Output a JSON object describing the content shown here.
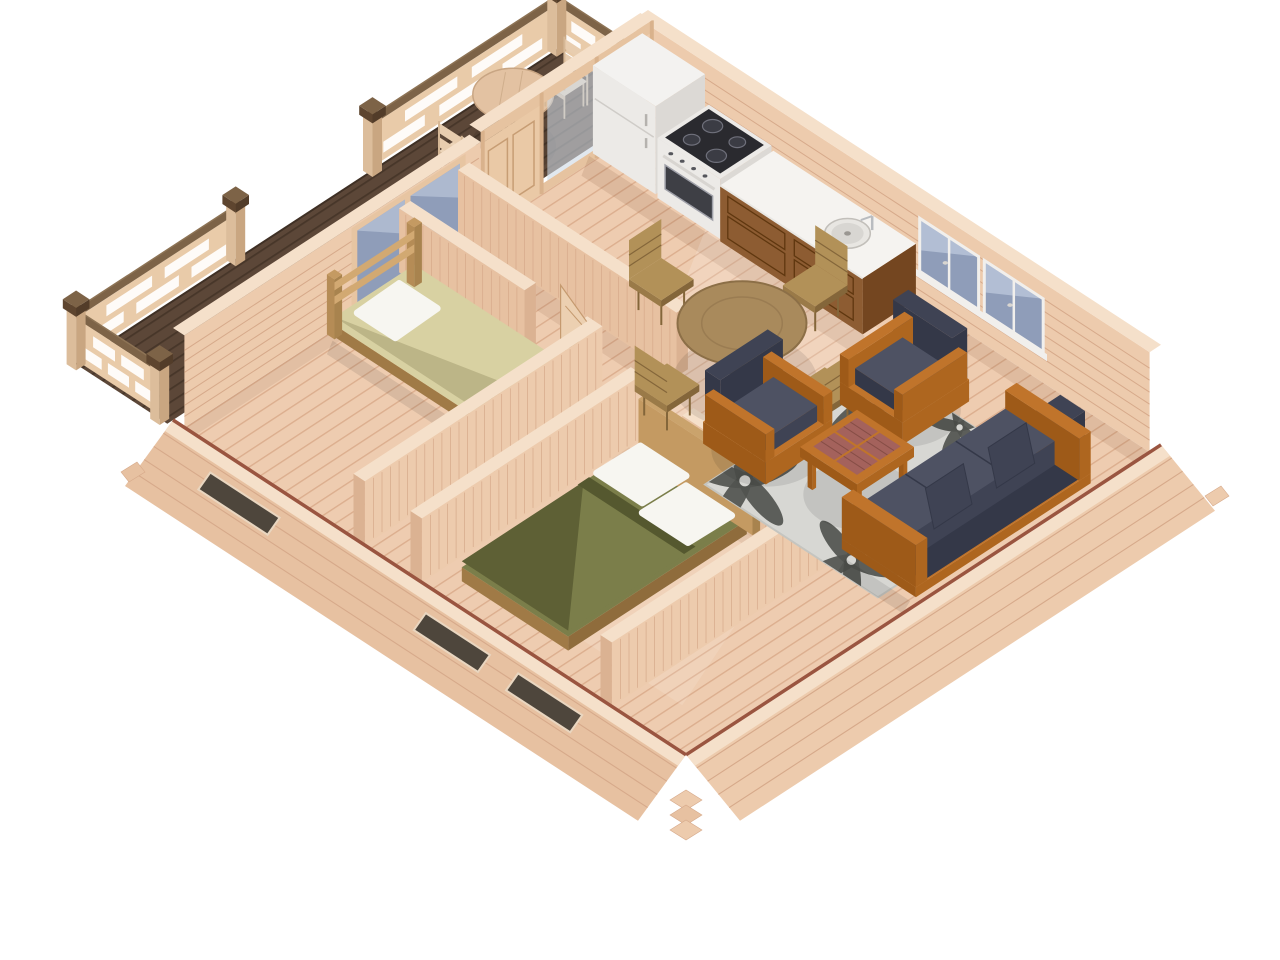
{
  "meta": {
    "kind": "3d-floorplan-render",
    "style": "isometric cutaway view of a one-storey log cabin",
    "background": "#ffffff"
  },
  "palette": {
    "floor": "#eeccb0",
    "floorLine": "#dcae8e",
    "deck": "#5c4738",
    "deckLine": "#473629",
    "wallFace": "#edcbad",
    "wallFaceAlt": "#e7c1a1",
    "wallLine": "#d6a98a",
    "wallTop": "#f5e0ca",
    "wallEnd": "#dbb292",
    "railWood": "#e9cba9",
    "railCap": "#7d6347",
    "postWood": "#dcbd9b",
    "postCap": "#6b5138",
    "trimRed": "#9a5540",
    "glassDark": "#8f9db9",
    "glassLight": "#b9c4d8",
    "glassPale": "#cdd8e4",
    "frameWhite": "#f1efec",
    "appWhite": "#f3f2f0",
    "appShade": "#eceae7",
    "appDark": "#dcd9d5",
    "cooktop": "#2a2a2f",
    "burner": "#3b3c44",
    "burnerRim": "#6f707b",
    "ovenGlass": "#3e3f45",
    "cabinet": "#8d5c32",
    "cabinetDark": "#744620",
    "cabinetLine": "#5f370f",
    "counterTop": "#f5f3f0",
    "sinkRim": "#c2bfba",
    "sinkBowl": "#d8d6d2",
    "steel": "#b9bcc0",
    "tableWood": "#a98a5c",
    "tableEdge": "#8c6f47",
    "pedestal": "#8f7450",
    "chairWood": "#b29158",
    "chairSide": "#9a7a48",
    "chairDark": "#84663a",
    "orange": "#c0742b",
    "orangeMid": "#ae661f",
    "orangeDark": "#9e5a18",
    "navy": "#4e5263",
    "navyMid": "#3f4354",
    "navyDark": "#343848",
    "lattice": "#a4625c",
    "rugBase": "#d7d7d3",
    "rugEdge": "#c5c5c0",
    "rugMotif": "#51544f",
    "bedBeige": "#d8d1a2",
    "olive": "#7b7e4a",
    "oliveShade": "#55582f",
    "pillow": "#f7f6f1",
    "headboard": "#c49a62",
    "bedFrameSW": "#a07a46",
    "bedFrameSE": "#8f6c3c",
    "doorWood": "#ecd0b1",
    "doorLine": "#c59a6f",
    "sunlight": "rgba(255,255,255,0.17)",
    "ambientShadow": "rgba(125,78,48,0.13)",
    "objectShadow": "rgba(0,0,0,0.09)"
  },
  "scene": {
    "rooms": [
      {
        "id": "terrace",
        "label": "Terrace deck with railing"
      },
      {
        "id": "kitchen",
        "label": "Kitchen"
      },
      {
        "id": "entry-hall",
        "label": "Entry hall"
      },
      {
        "id": "dining-area",
        "label": "Dining area"
      },
      {
        "id": "living-room",
        "label": "Living room"
      },
      {
        "id": "bedroom-1",
        "label": "Bedroom with single bed"
      },
      {
        "id": "bedroom-2",
        "label": "Bedroom with double bed"
      },
      {
        "id": "bathroom",
        "label": "Bathroom"
      }
    ],
    "furniture": [
      {
        "id": "fridge",
        "label": "Refrigerator"
      },
      {
        "id": "stove",
        "label": "Electric stove with oven"
      },
      {
        "id": "sink-cabinet",
        "label": "Kitchen sink cabinet"
      },
      {
        "id": "dining-table",
        "label": "Round dining table"
      },
      {
        "id": "dining-chairs",
        "label": "Four dining chairs"
      },
      {
        "id": "terrace-table",
        "label": "Round terrace table"
      },
      {
        "id": "terrace-chairs",
        "label": "Two folding terrace chairs"
      },
      {
        "id": "armchairs",
        "label": "Two cushioned armchairs"
      },
      {
        "id": "coffee-table",
        "label": "Slatted coffee table"
      },
      {
        "id": "sofa",
        "label": "Three-seat sofa with dark cushions"
      },
      {
        "id": "area-rug",
        "label": "Floral area rug"
      },
      {
        "id": "single-bed",
        "label": "Single bed with beige blanket"
      },
      {
        "id": "double-bed",
        "label": "Double bed with olive blanket"
      }
    ],
    "architecture": [
      {
        "id": "log-walls",
        "label": "Light timber log walls"
      },
      {
        "id": "glass-partition",
        "label": "Glazed terrace partition with door"
      },
      {
        "id": "windows",
        "label": "Casement windows"
      },
      {
        "id": "interior-doors",
        "label": "Interior panel doors"
      },
      {
        "id": "terrace-railing",
        "label": "Slatted wood railing"
      }
    ]
  }
}
